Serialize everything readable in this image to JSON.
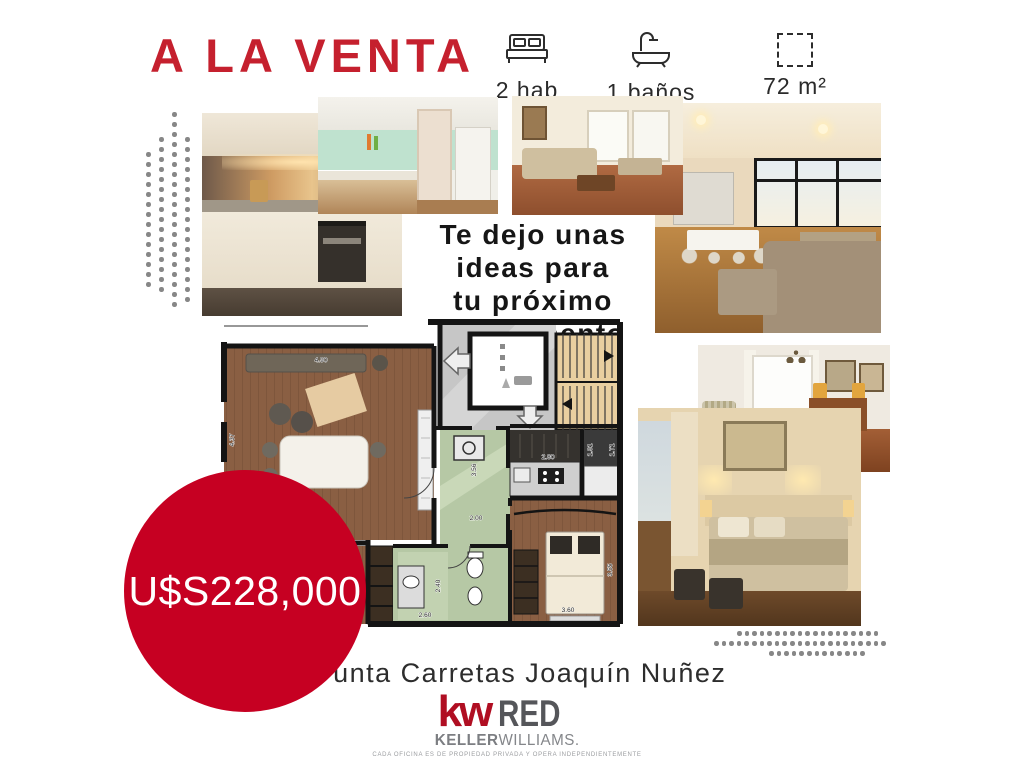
{
  "header": {
    "title": "A LA VENTA"
  },
  "features": [
    {
      "icon": "bed-icon",
      "label": "2 hab"
    },
    {
      "icon": "bath-icon",
      "label": "1 baños"
    },
    {
      "icon": "area-icon",
      "label": "72 m²"
    }
  ],
  "idea_text": {
    "line1": "Te dejo unas",
    "line2": "ideas para",
    "line3": "tu próximo",
    "line4": "apartamento"
  },
  "price": {
    "amount": "U$S228,000"
  },
  "location": {
    "text": "Punta Carretas Joaquín Nuñez"
  },
  "logo": {
    "kw": "kw",
    "brand": "RED",
    "keller": "KELLER",
    "williams": "WILLIAMS.",
    "disclaimer": "CADA OFICINA ES DE PROPIEDAD PRIVADA Y OPERA INDEPENDIENTEMENTE"
  },
  "floor_plan": {
    "dims": [
      "4.90",
      "4.37",
      "3.56",
      "2.00",
      "2.80",
      "1.91",
      "1.71",
      "2.40",
      "2.60",
      "3.60",
      "3.55"
    ]
  },
  "colors": {
    "accent_red": "#c5202e",
    "price_circle_red": "#c60022",
    "kw_red": "#b00e22",
    "text_dark": "#1f1f1f",
    "dots_gray": "#878787"
  }
}
